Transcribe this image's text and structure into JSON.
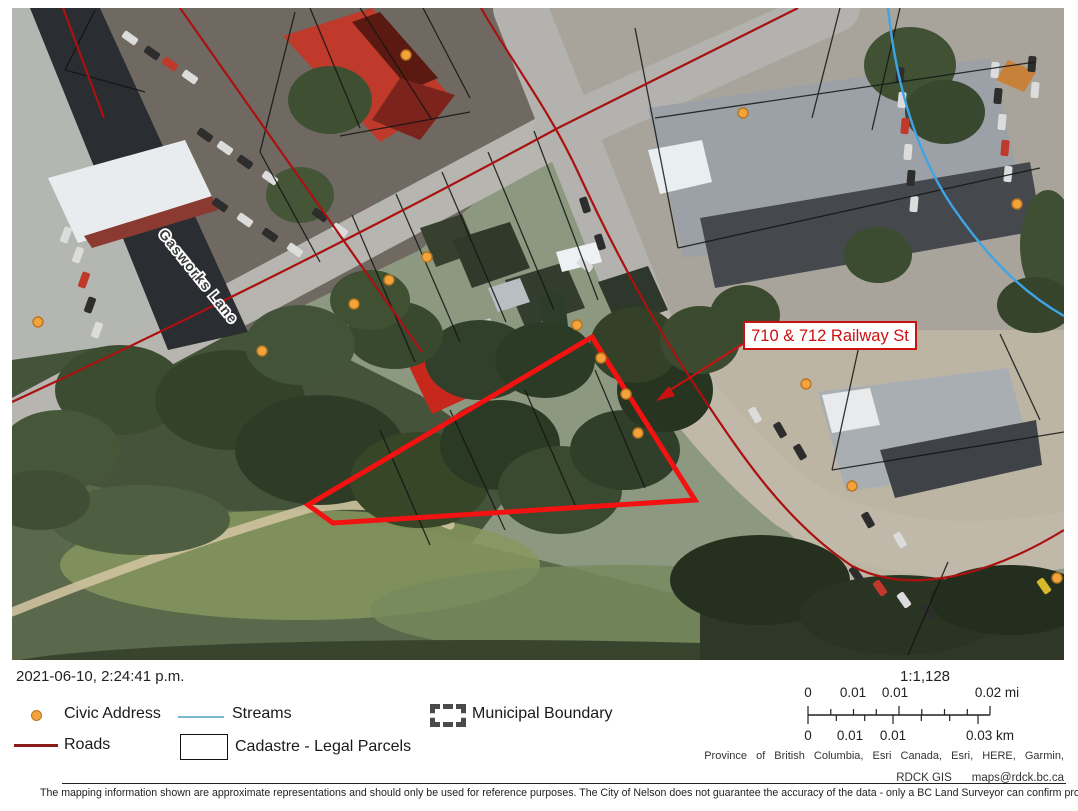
{
  "map": {
    "street_label": "Gasworks Lane",
    "callout_text": "710 & 712 Railway St"
  },
  "timestamp": "2021-06-10, 2:24:41 p.m.",
  "legend": {
    "civic_address": "Civic Address",
    "streams": "Streams",
    "municipal_boundary": "Municipal Boundary",
    "roads": "Roads",
    "cadastre": "Cadastre - Legal Parcels"
  },
  "scalebar": {
    "ratio": "1:1,128",
    "mi_labels": [
      "0",
      "0.01",
      "0.01",
      "0.02 mi"
    ],
    "km_labels": [
      "0",
      "0.01",
      "0.01",
      "0.03 km"
    ]
  },
  "footer": {
    "attribution": "Province of British Columbia, Esri Canada, Esri, HERE, Garmin,",
    "agency": "RDCK GIS",
    "email": "maps@rdck.bc.ca",
    "disclaimer": "The mapping information shown are approximate representations and should only be used for reference purposes. The City of Nelson does not guarantee the accuracy of the data - only a BC Land Surveyor can confirm property line and pin locations."
  },
  "colors": {
    "parcel_highlight": "#f21212",
    "roads_line": "#8b1a1a",
    "stream_line": "#3da4e6",
    "civic_dot": "#f2a33c"
  }
}
